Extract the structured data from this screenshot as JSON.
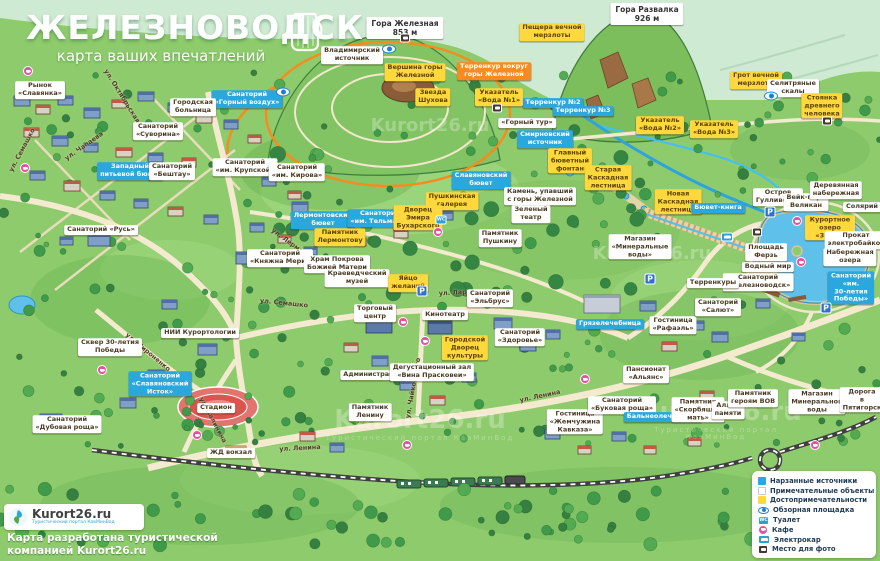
{
  "title": {
    "city": "ЖЕЛЕЗНОВОДСК",
    "subtitle": "карта ваших впечатлений"
  },
  "watermark": {
    "text": "Kurort26.ru",
    "tagline": "Туристический портал КавМинВод",
    "positions": [
      {
        "x": 430,
        "y": 126,
        "s": 18,
        "tag": false
      },
      {
        "x": 652,
        "y": 254,
        "s": 18,
        "tag": false
      },
      {
        "x": 420,
        "y": 424,
        "s": 26,
        "tag": true
      },
      {
        "x": 716,
        "y": 420,
        "s": 26,
        "tag": true
      }
    ]
  },
  "attribution": {
    "logo_text": "Kurort26.ru",
    "logo_tagline": "Туристический портал КавМинВод",
    "credit": "Карта разработана туристической\nкомпанией Kurort26.ru"
  },
  "legend": {
    "items": [
      {
        "type": "src",
        "label": "Нарзанные источники"
      },
      {
        "type": "obj",
        "label": "Примечательные объекты"
      },
      {
        "type": "sight",
        "label": "Достопримечательности"
      },
      {
        "type": "eye",
        "label": "Обзорная площадка"
      },
      {
        "type": "wc",
        "label": "Туалет"
      },
      {
        "type": "cafe",
        "label": "Кафе"
      },
      {
        "type": "electro",
        "label": "Электрокар"
      },
      {
        "type": "photo",
        "label": "Место для фото"
      }
    ]
  },
  "icon_glyphs": {
    "wc": "WC",
    "parking": "P"
  },
  "map": {
    "labels": [
      {
        "t": "Гора Железная\n853 м",
        "x": 405,
        "y": 28,
        "k": "p"
      },
      {
        "t": "Гора Развалка\n926 м",
        "x": 647,
        "y": 14,
        "k": "p"
      },
      {
        "t": "Владимирский\nисточник",
        "x": 352,
        "y": 55,
        "k": "w"
      },
      {
        "t": "Пещера вечной\nмерзлоты",
        "x": 552,
        "y": 32,
        "k": "y"
      },
      {
        "t": "Грот вечной\nмерзлоты",
        "x": 756,
        "y": 80,
        "k": "y"
      },
      {
        "t": "Селитряные\nскалы",
        "x": 793,
        "y": 88,
        "k": "w"
      },
      {
        "t": "Стоянка\nдревнего\nчеловека",
        "x": 822,
        "y": 106,
        "k": "y"
      },
      {
        "t": "Вершина горы\nЖелезной",
        "x": 415,
        "y": 72,
        "k": "y"
      },
      {
        "t": "Звезда\nШухова",
        "x": 433,
        "y": 97,
        "k": "y"
      },
      {
        "t": "Терренкур вокруг\nгоры Железной",
        "x": 494,
        "y": 71,
        "k": "o"
      },
      {
        "t": "Терренкур №2",
        "x": 553,
        "y": 103,
        "k": "c"
      },
      {
        "t": "Терренкур №3",
        "x": 583,
        "y": 111,
        "k": "c"
      },
      {
        "t": "Указатель\n«Вода №1»",
        "x": 499,
        "y": 97,
        "k": "y"
      },
      {
        "t": "Указатель\n«Вода №2»",
        "x": 660,
        "y": 125,
        "k": "y"
      },
      {
        "t": "Указатель\n«Вода №3»",
        "x": 714,
        "y": 129,
        "k": "y"
      },
      {
        "t": "«Горный тур»",
        "x": 527,
        "y": 123,
        "k": "w"
      },
      {
        "t": "Смирновский\nисточник",
        "x": 545,
        "y": 139,
        "k": "c"
      },
      {
        "t": "Главный\nбюветный\nфонтан",
        "x": 570,
        "y": 161,
        "k": "y"
      },
      {
        "t": "Старая\nКаскадная\nлестница",
        "x": 608,
        "y": 178,
        "k": "y"
      },
      {
        "t": "Славяновский\nбювет",
        "x": 481,
        "y": 180,
        "k": "c"
      },
      {
        "t": "Пушкинская\nгалерея",
        "x": 452,
        "y": 201,
        "k": "y"
      },
      {
        "t": "Камень, упавший\nс горы Железной",
        "x": 540,
        "y": 196,
        "k": "w"
      },
      {
        "t": "Зеленый\nтеатр",
        "x": 531,
        "y": 214,
        "k": "w"
      },
      {
        "t": "Памятник\nПушкину",
        "x": 500,
        "y": 238,
        "k": "w"
      },
      {
        "t": "Санаторий\n«Горный воздух»",
        "x": 247,
        "y": 99,
        "k": "c"
      },
      {
        "t": "Рынок\n«Славянка»",
        "x": 40,
        "y": 90,
        "k": "w"
      },
      {
        "t": "Городская\nбольница",
        "x": 193,
        "y": 107,
        "k": "w"
      },
      {
        "t": "Санаторий\n«Суворина»",
        "x": 158,
        "y": 131,
        "k": "w"
      },
      {
        "t": "Санаторий\n«им. Крупской»",
        "x": 245,
        "y": 167,
        "k": "w"
      },
      {
        "t": "Санаторий\n«им. Кирова»",
        "x": 297,
        "y": 172,
        "k": "w"
      },
      {
        "t": "Западный\nпитьевой бювет",
        "x": 130,
        "y": 171,
        "k": "c"
      },
      {
        "t": "Санаторий\n«Бештау»",
        "x": 172,
        "y": 171,
        "k": "w"
      },
      {
        "t": "Санаторий «Русь»",
        "x": 101,
        "y": 230,
        "k": "w"
      },
      {
        "t": "Лермонтовский\nбювет",
        "x": 323,
        "y": 220,
        "k": "c"
      },
      {
        "t": "Памятник\nЛермонтову",
        "x": 340,
        "y": 237,
        "k": "y"
      },
      {
        "t": "Санаторий\n«им. Тельмана»",
        "x": 380,
        "y": 218,
        "k": "c"
      },
      {
        "t": "Дворец\nЭмира\nБухарского",
        "x": 418,
        "y": 218,
        "k": "y"
      },
      {
        "t": "Санаторий\n«Княжна Мери»",
        "x": 280,
        "y": 258,
        "k": "w"
      },
      {
        "t": "Храм Покрова\nБожией Матери",
        "x": 337,
        "y": 264,
        "k": "w"
      },
      {
        "t": "Краеведческий\nмузей",
        "x": 357,
        "y": 278,
        "k": "w"
      },
      {
        "t": "Яйцо\nжеланий",
        "x": 408,
        "y": 283,
        "k": "y"
      },
      {
        "t": "Новая\nКаскадная\nлестница",
        "x": 678,
        "y": 202,
        "k": "y"
      },
      {
        "t": "Бювет-книга",
        "x": 718,
        "y": 208,
        "k": "c"
      },
      {
        "t": "Остров\nГулливеров",
        "x": 778,
        "y": 197,
        "k": "w"
      },
      {
        "t": "Вейк-парк\nВеликан",
        "x": 806,
        "y": 202,
        "k": "w"
      },
      {
        "t": "Деревянная\nнабережная",
        "x": 836,
        "y": 190,
        "k": "w"
      },
      {
        "t": "Солярий",
        "x": 862,
        "y": 207,
        "k": "w"
      },
      {
        "t": "Курортное озеро\n«30'Ка»",
        "x": 830,
        "y": 228,
        "k": "y"
      },
      {
        "t": "Прокат\nэлектробайков",
        "x": 856,
        "y": 240,
        "k": "w"
      },
      {
        "t": "Набережная\nозера",
        "x": 850,
        "y": 257,
        "k": "w"
      },
      {
        "t": "Площадь\nФерзь",
        "x": 766,
        "y": 252,
        "k": "w"
      },
      {
        "t": "Водный мир",
        "x": 768,
        "y": 267,
        "k": "w"
      },
      {
        "t": "Санаторий\n«Железноводск»",
        "x": 758,
        "y": 282,
        "k": "w"
      },
      {
        "t": "Санаторий «им.\n30-летия Победы»",
        "x": 851,
        "y": 288,
        "k": "c"
      },
      {
        "t": "Магазин\n«Минеральные\nводы»",
        "x": 640,
        "y": 247,
        "k": "w"
      },
      {
        "t": "Терренкуры",
        "x": 713,
        "y": 283,
        "k": "w"
      },
      {
        "t": "Грязелечебница",
        "x": 610,
        "y": 324,
        "k": "c"
      },
      {
        "t": "Гостиница\n«Рафаэль»",
        "x": 673,
        "y": 325,
        "k": "w"
      },
      {
        "t": "Санаторий\n«Салют»",
        "x": 718,
        "y": 307,
        "k": "w"
      },
      {
        "t": "Пансионат\n«Альянс»",
        "x": 646,
        "y": 374,
        "k": "w"
      },
      {
        "t": "Санаторий\n«Здоровье»",
        "x": 520,
        "y": 337,
        "k": "w"
      },
      {
        "t": "Торговый\nцентр",
        "x": 375,
        "y": 313,
        "k": "w"
      },
      {
        "t": "Кинотеатр",
        "x": 445,
        "y": 315,
        "k": "w"
      },
      {
        "t": "Городской\nДворец\nкультуры",
        "x": 465,
        "y": 348,
        "k": "y"
      },
      {
        "t": "Санаторий\n«Эльбрус»",
        "x": 490,
        "y": 298,
        "k": "w"
      },
      {
        "t": "Администрация",
        "x": 373,
        "y": 375,
        "k": "w"
      },
      {
        "t": "Дегустационный зал\n«Вина Прасковеи»",
        "x": 432,
        "y": 372,
        "k": "w"
      },
      {
        "t": "Памятник\nЛенину",
        "x": 370,
        "y": 412,
        "k": "w"
      },
      {
        "t": "Сквер 30-летия\nПобеды",
        "x": 110,
        "y": 347,
        "k": "w"
      },
      {
        "t": "НИИ Курортологии",
        "x": 200,
        "y": 333,
        "k": "w"
      },
      {
        "t": "Санаторий\n«Славяновский\nИсток»",
        "x": 160,
        "y": 384,
        "k": "c"
      },
      {
        "t": "Санаторий\n«Дубовая роща»",
        "x": 67,
        "y": 424,
        "k": "w"
      },
      {
        "t": "Стадион",
        "x": 216,
        "y": 408,
        "k": "w"
      },
      {
        "t": "ЖД вокзал",
        "x": 231,
        "y": 453,
        "k": "w"
      },
      {
        "t": "Гостиница\n«Жемчужина\nКавказа»",
        "x": 575,
        "y": 422,
        "k": "w"
      },
      {
        "t": "Санаторий\n«Буковая роща»",
        "x": 622,
        "y": 405,
        "k": "w"
      },
      {
        "t": "Бальнеолечебница",
        "x": 663,
        "y": 417,
        "k": "c"
      },
      {
        "t": "Памятник\n«Скорбящая\nмать»",
        "x": 698,
        "y": 410,
        "k": "w"
      },
      {
        "t": "Аллея\nпамяти",
        "x": 728,
        "y": 410,
        "k": "w"
      },
      {
        "t": "Памятник\nгероям ВОВ",
        "x": 753,
        "y": 398,
        "k": "w"
      },
      {
        "t": "Магазин\nМинеральной\nводы",
        "x": 817,
        "y": 402,
        "k": "w"
      },
      {
        "t": "Дорога\nв Пятигорск",
        "x": 862,
        "y": 400,
        "k": "w"
      }
    ],
    "streets": [
      {
        "t": "ул. Октябрьская",
        "x": 122,
        "y": 96,
        "a": 58
      },
      {
        "t": "ул. Чапаева",
        "x": 84,
        "y": 146,
        "a": -35
      },
      {
        "t": "ул. Семашко",
        "x": 22,
        "y": 150,
        "a": -62
      },
      {
        "t": "ул. Лермонтова",
        "x": 296,
        "y": 247,
        "a": 36
      },
      {
        "t": "ул. Семашко",
        "x": 284,
        "y": 303,
        "a": 6
      },
      {
        "t": "ул. Чайковского",
        "x": 413,
        "y": 388,
        "a": -80
      },
      {
        "t": "ул. Ларионова",
        "x": 466,
        "y": 292,
        "a": -3
      },
      {
        "t": "ул. Ленина",
        "x": 540,
        "y": 396,
        "a": -12
      },
      {
        "t": "ул. Ленина",
        "x": 300,
        "y": 448,
        "a": -3
      },
      {
        "t": "ул. Калинина",
        "x": 213,
        "y": 420,
        "a": 62
      },
      {
        "t": "ул. Мироненко",
        "x": 148,
        "y": 352,
        "a": 40
      }
    ],
    "icons": [
      {
        "t": "eye",
        "x": 283,
        "y": 92
      },
      {
        "t": "eye",
        "x": 389,
        "y": 49
      },
      {
        "t": "eye",
        "x": 771,
        "y": 96
      },
      {
        "t": "photo",
        "x": 405,
        "y": 38
      },
      {
        "t": "photo",
        "x": 497,
        "y": 108
      },
      {
        "t": "photo",
        "x": 827,
        "y": 121
      },
      {
        "t": "photo",
        "x": 757,
        "y": 232
      },
      {
        "t": "wc",
        "x": 441,
        "y": 220
      },
      {
        "t": "parking",
        "x": 770,
        "y": 212
      },
      {
        "t": "parking",
        "x": 826,
        "y": 308
      },
      {
        "t": "parking",
        "x": 422,
        "y": 291
      },
      {
        "t": "parking",
        "x": 650,
        "y": 279
      },
      {
        "t": "electro",
        "x": 727,
        "y": 237
      },
      {
        "t": "cafe",
        "x": 28,
        "y": 71
      },
      {
        "t": "cafe",
        "x": 25,
        "y": 168
      },
      {
        "t": "cafe",
        "x": 403,
        "y": 322
      },
      {
        "t": "cafe",
        "x": 425,
        "y": 341
      },
      {
        "t": "cafe",
        "x": 407,
        "y": 445
      },
      {
        "t": "cafe",
        "x": 438,
        "y": 232
      },
      {
        "t": "cafe",
        "x": 797,
        "y": 221
      },
      {
        "t": "cafe",
        "x": 801,
        "y": 262
      },
      {
        "t": "cafe",
        "x": 197,
        "y": 435
      },
      {
        "t": "cafe",
        "x": 815,
        "y": 445
      },
      {
        "t": "cafe",
        "x": 102,
        "y": 370
      },
      {
        "t": "cafe",
        "x": 585,
        "y": 379
      }
    ]
  },
  "decor": {
    "buildings": [
      [
        14,
        96,
        16,
        10,
        "b"
      ],
      [
        36,
        105,
        14,
        9,
        "r"
      ],
      [
        58,
        96,
        15,
        9,
        "b"
      ],
      [
        84,
        108,
        16,
        10,
        "b"
      ],
      [
        112,
        100,
        14,
        8,
        "r"
      ],
      [
        138,
        92,
        16,
        9,
        "b"
      ],
      [
        168,
        103,
        15,
        9,
        "b"
      ],
      [
        196,
        113,
        16,
        10,
        "r"
      ],
      [
        24,
        128,
        15,
        9,
        "r"
      ],
      [
        52,
        136,
        16,
        10,
        "b"
      ],
      [
        84,
        143,
        14,
        9,
        "b"
      ],
      [
        116,
        148,
        16,
        9,
        "r"
      ],
      [
        148,
        153,
        15,
        9,
        "b"
      ],
      [
        182,
        158,
        14,
        9,
        "r"
      ],
      [
        30,
        171,
        15,
        9,
        "b"
      ],
      [
        64,
        181,
        16,
        10,
        "r"
      ],
      [
        100,
        191,
        15,
        9,
        "b"
      ],
      [
        134,
        199,
        14,
        9,
        "b"
      ],
      [
        168,
        207,
        15,
        9,
        "r"
      ],
      [
        204,
        215,
        14,
        9,
        "b"
      ],
      [
        224,
        120,
        14,
        9,
        "b"
      ],
      [
        248,
        135,
        13,
        8,
        "r"
      ],
      [
        262,
        177,
        14,
        9,
        "b"
      ],
      [
        288,
        191,
        13,
        8,
        "r"
      ],
      [
        250,
        223,
        14,
        9,
        "b"
      ],
      [
        278,
        235,
        13,
        8,
        "r"
      ],
      [
        96,
        227,
        14,
        8,
        "r"
      ],
      [
        60,
        237,
        13,
        8,
        "b"
      ],
      [
        304,
        247,
        13,
        8,
        "b"
      ],
      [
        236,
        252,
        20,
        12,
        "b"
      ],
      [
        292,
        202,
        16,
        10,
        "b"
      ],
      [
        326,
        257,
        13,
        9,
        "r"
      ],
      [
        354,
        238,
        12,
        8,
        "r"
      ],
      [
        394,
        229,
        14,
        9,
        "r"
      ],
      [
        436,
        211,
        17,
        9,
        "b"
      ],
      [
        88,
        234,
        22,
        12,
        "b"
      ],
      [
        40,
        414,
        22,
        13,
        "b"
      ],
      [
        120,
        398,
        16,
        10,
        "b"
      ],
      [
        148,
        370,
        17,
        10,
        "b"
      ],
      [
        198,
        344,
        19,
        11,
        "b"
      ],
      [
        226,
        446,
        20,
        9,
        "y"
      ],
      [
        162,
        300,
        15,
        9,
        "b"
      ],
      [
        366,
        320,
        26,
        13,
        "d"
      ],
      [
        428,
        321,
        24,
        13,
        "d"
      ],
      [
        458,
        340,
        20,
        11,
        "d"
      ],
      [
        372,
        356,
        16,
        10,
        "b"
      ],
      [
        344,
        343,
        14,
        9,
        "r"
      ],
      [
        400,
        381,
        14,
        9,
        "b"
      ],
      [
        430,
        396,
        15,
        9,
        "r"
      ],
      [
        462,
        373,
        14,
        9,
        "b"
      ],
      [
        494,
        318,
        18,
        11,
        "b"
      ],
      [
        520,
        341,
        16,
        10,
        "b"
      ],
      [
        546,
        330,
        14,
        9,
        "b"
      ],
      [
        300,
        432,
        15,
        9,
        "r"
      ],
      [
        330,
        443,
        14,
        9,
        "b"
      ],
      [
        584,
        295,
        36,
        18,
        "g"
      ],
      [
        640,
        301,
        16,
        10,
        "b"
      ],
      [
        662,
        342,
        15,
        9,
        "r"
      ],
      [
        690,
        321,
        14,
        9,
        "b"
      ],
      [
        712,
        332,
        16,
        10,
        "b"
      ],
      [
        736,
        391,
        15,
        9,
        "r"
      ],
      [
        700,
        391,
        14,
        9,
        "r"
      ],
      [
        756,
        299,
        14,
        9,
        "b"
      ],
      [
        792,
        333,
        13,
        8,
        "b"
      ],
      [
        846,
        286,
        16,
        10,
        "b"
      ],
      [
        838,
        390,
        14,
        9,
        "r"
      ],
      [
        610,
        397,
        19,
        11,
        "b"
      ],
      [
        560,
        412,
        19,
        10,
        "b"
      ],
      [
        545,
        430,
        15,
        9,
        "b"
      ],
      [
        578,
        446,
        13,
        8,
        "r"
      ],
      [
        612,
        432,
        14,
        9,
        "b"
      ],
      [
        644,
        446,
        12,
        8,
        "r"
      ],
      [
        688,
        438,
        13,
        8,
        "r"
      ]
    ]
  }
}
